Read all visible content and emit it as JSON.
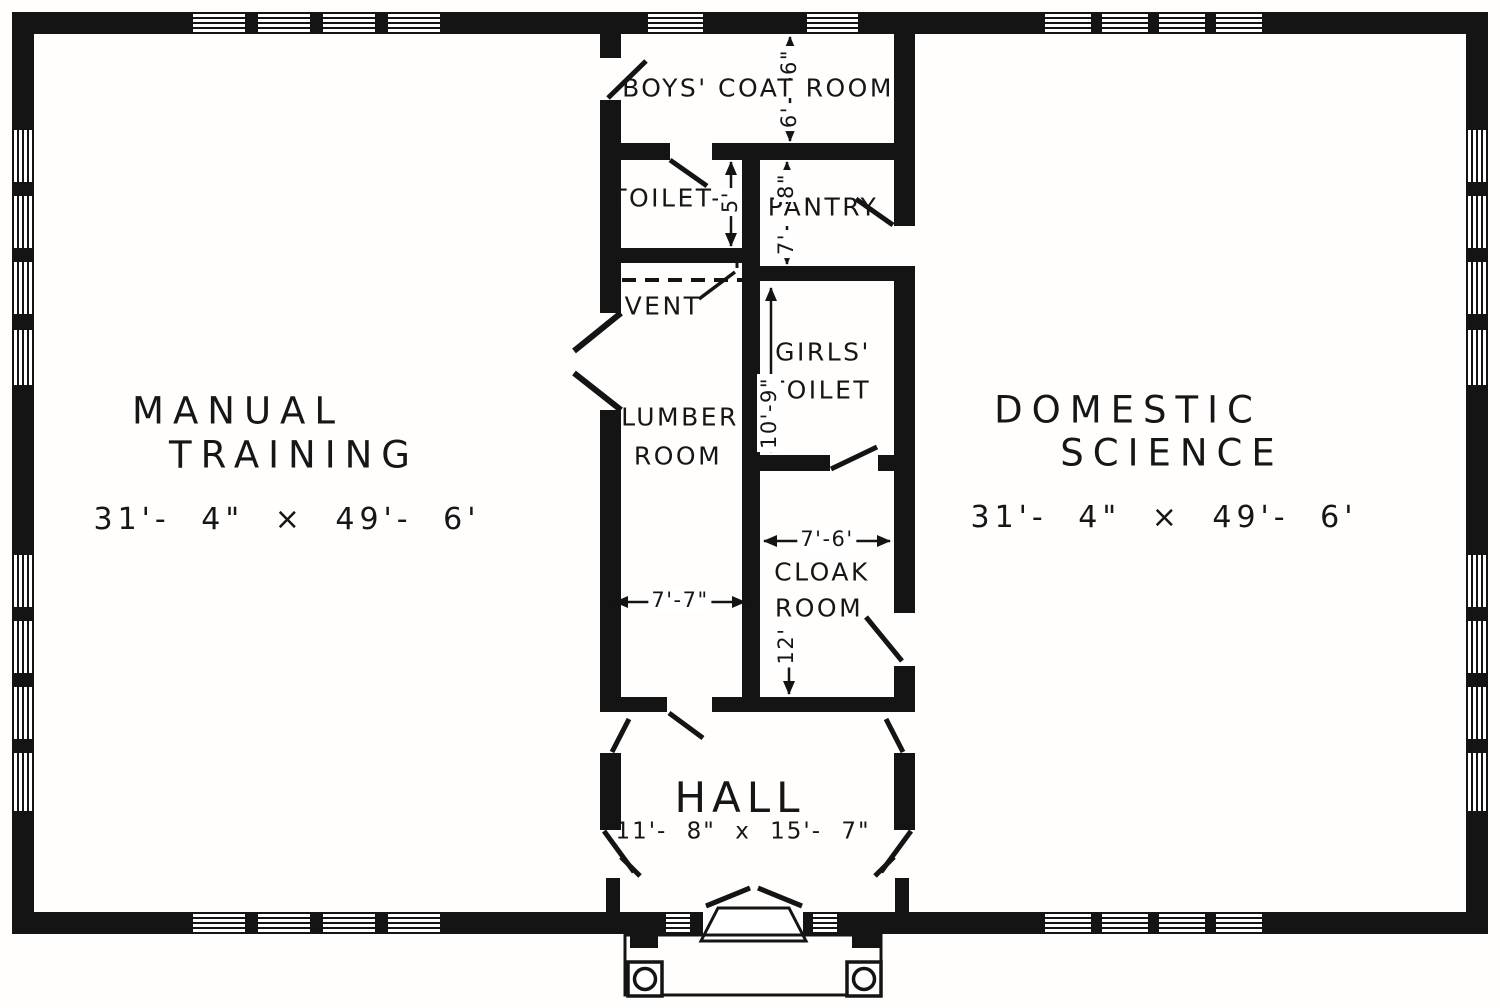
{
  "drawing": {
    "type": "school building floor plan",
    "ink_color": "#141414",
    "paper_color": "#fffefd"
  },
  "rooms": {
    "manual_training": {
      "name_line1": "MANUAL",
      "name_line2": "TRAINING",
      "dimensions": "31'- 4\" × 49'- 6'"
    },
    "domestic_science": {
      "name_line1": "DOMESTIC",
      "name_line2": "SCIENCE",
      "dimensions": "31'- 4\" × 49'- 6'"
    },
    "boys_coat_room": {
      "name": "BOYS' COAT ROOM"
    },
    "toilet": {
      "name": "TOILET-"
    },
    "pantry": {
      "name": "PANTRY"
    },
    "vent": {
      "name": "VENT"
    },
    "girls_toilet": {
      "name_line1": "GIRLS'",
      "name_line2": "TOILET"
    },
    "lumber_room": {
      "name_line1": "LUMBER",
      "name_line2": "ROOM"
    },
    "cloak_room": {
      "name_line1": "CLOAK",
      "name_line2": "ROOM"
    },
    "hall": {
      "name": "HALL",
      "dimensions": "11'- 8\" x 15'- 7\""
    }
  },
  "dimension_labels": {
    "coat_room_depth_upper": "6\"",
    "coat_room_depth_lower": "6'",
    "pantry_depth_upper": "8\"",
    "pantry_depth_lower": "7'",
    "toilet_depth": "5'",
    "girls_toilet_depth": "10'-9\"",
    "cloak_room_width": "7'-6'",
    "cloak_room_depth": "12'",
    "lumber_room_width": "7'-7\""
  }
}
